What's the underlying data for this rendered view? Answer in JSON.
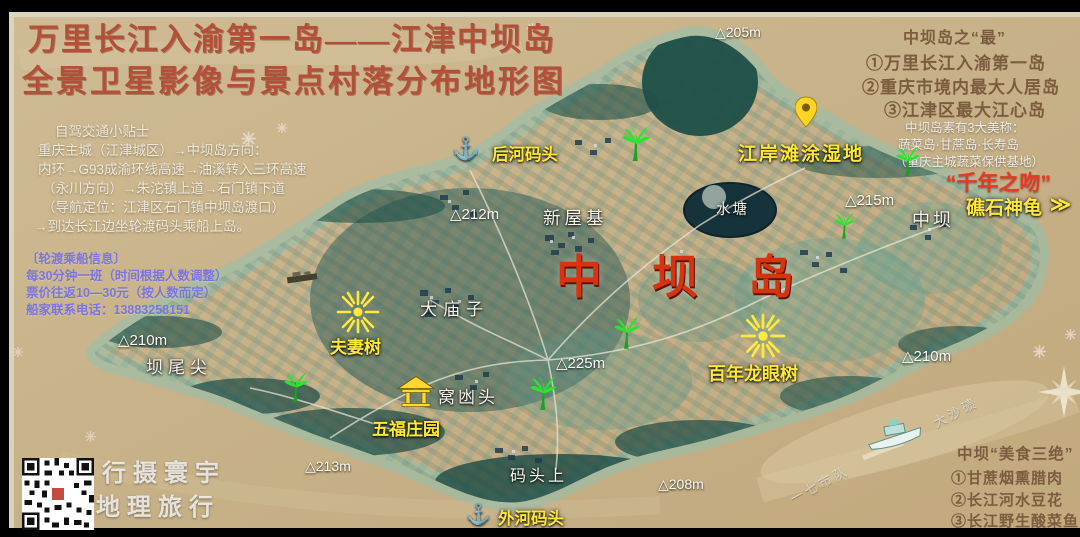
{
  "title": {
    "line1": "万里长江入渝第一岛——江津中坝岛",
    "line2": "全景卫星影像与景点村落分布地形图"
  },
  "driving_tips": {
    "lines": [
      "自驾交通小贴士",
      "重庆主城（江津城区）→中坝岛方向：",
      "内环→G93成渝环线高速→油溪转入三环高速",
      "（永川方向）→朱沱镇上道→石门镇下道",
      "（导航定位：江津区石门镇中坝岛渡口）",
      "→到达长江边坐轮渡码头乘船上岛。"
    ]
  },
  "ferry_info": {
    "lines": [
      "〔轮渡乘船信息〕",
      "每30分钟一班（时间根据人数调整）",
      "票价往返10—30元（按人数而定）",
      "船家联系电话：13883258151"
    ]
  },
  "superlatives": {
    "heading": "中坝岛之“最”",
    "items": [
      "①万里长江入渝第一岛",
      "②重庆市境内最大人居岛",
      "③江津区最大江心岛"
    ]
  },
  "nicknames": {
    "lines": [
      "中坝岛素有3大美称：",
      "蔬菜岛·甘蔗岛·长寿岛",
      "（重庆主城蔬菜保供基地）"
    ]
  },
  "food": {
    "heading": "中坝“美食三绝”",
    "items": [
      "①甘蔗烟熏腊肉",
      "②长江河水豆花",
      "③长江野生酸菜鱼"
    ]
  },
  "labels": {
    "island_big": "中坝岛",
    "kiss": "“千年之吻”",
    "reef_turtle": "礁石神龟",
    "zhongba_village": "中坝",
    "houhe_wharf": "后河码头",
    "riverbank_wetland": "江岸滩涂湿地",
    "pond": "水塘",
    "xinwuji": "新屋基",
    "damiaozi": "大庙子",
    "couple_tree": "夫妻树",
    "wufu_manor": "五福庄园",
    "wodangtou": "窝凼头",
    "centennial_longan": "百年龙眼树",
    "bawaijian": "坝尾尖",
    "matoushang": "码头上",
    "waihe_wharf": "外河码头",
    "diag_team": "一七市队",
    "diag_sandbar": "大沙碛"
  },
  "elevations": {
    "e205": "△205m",
    "e212": "△212m",
    "e215": "△215m",
    "e225": "△225m",
    "e210_left": "△210m",
    "e210_right": "△210m",
    "e213": "△213m",
    "e208": "△208m"
  },
  "watermark": {
    "line1": "行摄寰宇",
    "line2": "地理旅行"
  },
  "icons": {
    "anchor": "⚓",
    "turtle_mark": "≫"
  },
  "colors": {
    "river": "#c9b48d",
    "island": "#3e7e76",
    "title_red": "#b2503a",
    "label_yellow": "#ffe83a",
    "big_red": "#d6330e",
    "kiss_red": "#e8391f",
    "ferry_blue": "#7b74dc",
    "facts_brown": "#7c5c3e"
  }
}
